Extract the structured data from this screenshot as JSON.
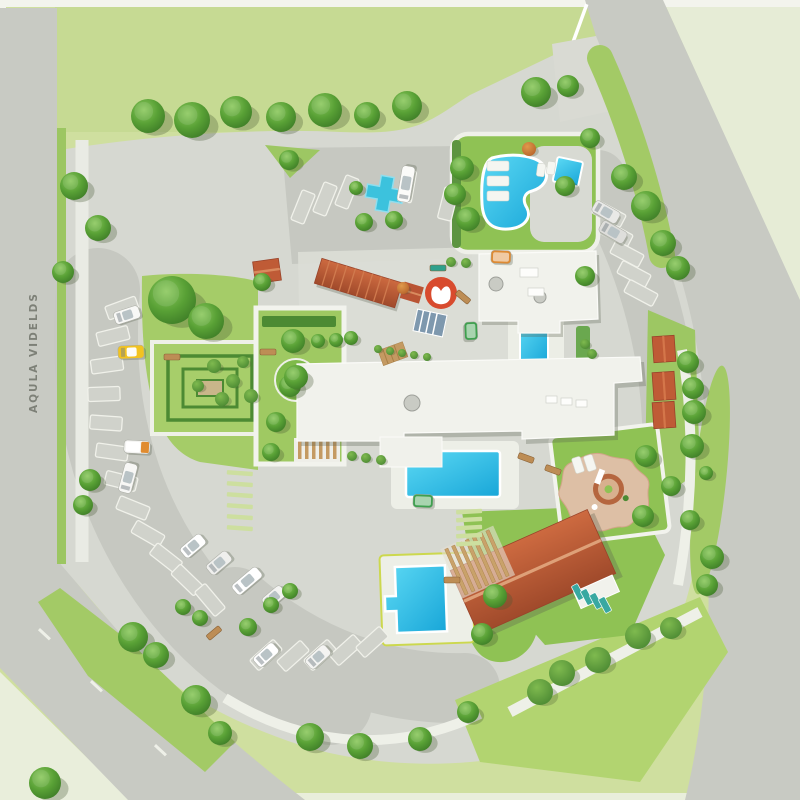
{
  "labels": {
    "road_label": "AQULA VIDELDS"
  },
  "palette": {
    "outer_lawn": "#cfdf9f",
    "top_lawn": "#c6da93",
    "pale_field": "#e6ecd6",
    "pale_corner": "#e9eedb",
    "road": "#c8cac3",
    "pavement": "#d6d8d1",
    "parking": "#c6c8c1",
    "plaza": "#dcded6",
    "path": "#f0f1ea",
    "white": "#f5f6f1",
    "stall": "#d0d2cb",
    "stripe": "#cddf9f",
    "lawn": "#8fc254",
    "lawn_mid": "#a5cc68",
    "lawn_bright": "#b2d470",
    "hedge": "#4c8a33",
    "water": "#2cc3e8",
    "water_deep": "#14a0d2",
    "roof_white": "#f1f2ec",
    "terracotta": "#bf5b36",
    "terracotta_dark": "#a04a2b",
    "logo_red": "#d84b2e",
    "taxi": "#f2c320",
    "teal": "#38a8a1",
    "wood": "#bd8d55",
    "sand": "#ddbfa5",
    "sand_ring": "#b5663f",
    "text": "#70746a"
  },
  "features_named": [
    "lagoon-pool",
    "spa-pool",
    "courtyard-pool",
    "main-pool",
    "family-pool",
    "splash-pad-cross",
    "hedge-maze-garden",
    "terrace-garden",
    "playground-star",
    "restaurant-red-roof",
    "entrance-canopy",
    "cabana-roofs",
    "resort-logo",
    "parking-left-arc",
    "parking-top",
    "parking-right-arc",
    "parking-bottom",
    "ring-road",
    "perimeter-roads",
    "taxi",
    "shuttle-buses",
    "gate-barrier"
  ],
  "features": {
    "trees": [
      [
        148,
        116,
        17
      ],
      [
        192,
        120,
        18
      ],
      [
        236,
        112,
        16
      ],
      [
        281,
        117,
        15
      ],
      [
        325,
        110,
        17
      ],
      [
        367,
        115,
        13
      ],
      [
        407,
        106,
        15
      ],
      [
        536,
        92,
        15
      ],
      [
        568,
        86,
        11
      ],
      [
        590,
        138,
        10
      ],
      [
        462,
        168,
        12
      ],
      [
        455,
        194,
        11
      ],
      [
        468,
        219,
        12
      ],
      [
        565,
        186,
        10
      ],
      [
        624,
        177,
        13
      ],
      [
        646,
        206,
        15
      ],
      [
        663,
        243,
        13
      ],
      [
        678,
        268,
        12
      ],
      [
        585,
        276,
        10
      ],
      [
        688,
        362,
        11
      ],
      [
        693,
        388,
        11
      ],
      [
        694,
        412,
        12
      ],
      [
        692,
        446,
        12
      ],
      [
        706,
        473,
        7
      ],
      [
        690,
        520,
        10
      ],
      [
        712,
        557,
        12
      ],
      [
        707,
        585,
        11
      ],
      [
        74,
        186,
        14
      ],
      [
        98,
        228,
        13
      ],
      [
        63,
        272,
        11
      ],
      [
        90,
        480,
        11
      ],
      [
        83,
        505,
        10
      ],
      [
        172,
        300,
        24
      ],
      [
        206,
        321,
        18
      ],
      [
        293,
        341,
        12
      ],
      [
        290,
        386,
        11
      ],
      [
        276,
        422,
        10
      ],
      [
        271,
        452,
        9
      ],
      [
        296,
        377,
        12
      ],
      [
        318,
        341,
        7
      ],
      [
        336,
        340,
        7
      ],
      [
        351,
        338,
        7
      ],
      [
        262,
        282,
        9
      ],
      [
        289,
        160,
        10
      ],
      [
        356,
        188,
        7
      ],
      [
        364,
        222,
        9
      ],
      [
        394,
        220,
        9
      ],
      [
        646,
        456,
        11
      ],
      [
        643,
        516,
        11
      ],
      [
        671,
        486,
        10
      ],
      [
        495,
        596,
        12
      ],
      [
        482,
        634,
        11
      ],
      [
        133,
        637,
        15
      ],
      [
        156,
        655,
        13
      ],
      [
        196,
        700,
        15
      ],
      [
        220,
        733,
        12
      ],
      [
        45,
        783,
        16
      ],
      [
        310,
        737,
        14
      ],
      [
        360,
        746,
        13
      ],
      [
        420,
        739,
        12
      ],
      [
        468,
        712,
        11
      ],
      [
        183,
        607,
        8
      ],
      [
        200,
        618,
        8
      ],
      [
        248,
        627,
        9
      ],
      [
        271,
        605,
        8
      ],
      [
        290,
        591,
        8
      ]
    ],
    "bushes": [
      [
        378,
        349,
        4
      ],
      [
        390,
        351,
        4
      ],
      [
        402,
        353,
        4
      ],
      [
        414,
        355,
        4
      ],
      [
        427,
        357,
        4
      ],
      [
        451,
        262,
        5
      ],
      [
        466,
        263,
        5
      ],
      [
        585,
        344,
        5
      ],
      [
        592,
        354,
        5
      ],
      [
        352,
        456,
        5
      ],
      [
        366,
        458,
        5
      ],
      [
        381,
        460,
        5
      ],
      [
        540,
        692,
        13
      ],
      [
        562,
        673,
        13
      ],
      [
        598,
        660,
        13
      ],
      [
        638,
        636,
        13
      ],
      [
        671,
        628,
        11
      ],
      [
        214,
        366,
        7
      ],
      [
        233,
        381,
        7
      ],
      [
        251,
        396,
        7
      ],
      [
        222,
        399,
        7
      ],
      [
        198,
        386,
        6
      ],
      [
        243,
        362,
        6
      ],
      [
        529,
        149,
        7,
        "orange"
      ],
      [
        403,
        288,
        6,
        "orange"
      ]
    ],
    "parking_stalls": [
      [
        122,
        308,
        -20
      ],
      [
        113,
        336,
        -14
      ],
      [
        107,
        365,
        -8
      ],
      [
        104,
        394,
        -2
      ],
      [
        106,
        423,
        4
      ],
      [
        112,
        452,
        8
      ],
      [
        121,
        481,
        14
      ],
      [
        133,
        508,
        22
      ],
      [
        148,
        534,
        30
      ],
      [
        166,
        558,
        38
      ],
      [
        187,
        580,
        44
      ],
      [
        210,
        600,
        50
      ],
      [
        266,
        655,
        -42
      ],
      [
        293,
        656,
        -42
      ],
      [
        320,
        655,
        -42
      ],
      [
        346,
        650,
        -42
      ],
      [
        372,
        642,
        -42
      ],
      [
        303,
        207,
        -68
      ],
      [
        325,
        199,
        -68
      ],
      [
        347,
        192,
        -68
      ],
      [
        407,
        186,
        -80
      ],
      [
        448,
        204,
        -76
      ],
      [
        609,
        214,
        28
      ],
      [
        616,
        234,
        28
      ],
      [
        627,
        254,
        28
      ],
      [
        634,
        274,
        28
      ],
      [
        641,
        293,
        28
      ]
    ],
    "vehicles": [
      [
        127,
        315,
        -18,
        "#f8f8f6",
        26
      ],
      [
        131,
        352,
        -2,
        "#f2c320",
        26,
        "taxi"
      ],
      [
        137,
        447,
        3,
        "#f4f4f2",
        26,
        "truck"
      ],
      [
        128,
        478,
        -75,
        "#f7f7f5",
        30
      ],
      [
        193,
        546,
        -40,
        "#ffffff",
        26
      ],
      [
        219,
        563,
        -40,
        "#efefed",
        26
      ],
      [
        247,
        581,
        -40,
        "#ffffff",
        32
      ],
      [
        274,
        597,
        -40,
        "#f3f3f1",
        24
      ],
      [
        266,
        655,
        -42,
        "#ffffff",
        26
      ],
      [
        318,
        657,
        -42,
        "#f4f4f2",
        26
      ],
      [
        406,
        184,
        -80,
        "#fbfbf9",
        36,
        "van"
      ],
      [
        606,
        212,
        30,
        "#e9e9e7",
        28
      ],
      [
        613,
        232,
        30,
        "#dededb",
        28
      ],
      [
        501,
        257,
        2,
        "#dd8a33",
        20,
        "bus"
      ],
      [
        471,
        331,
        88,
        "#3fa04f",
        18,
        "bus"
      ],
      [
        423,
        501,
        2,
        "#3fa04f",
        20,
        "bus"
      ]
    ],
    "teal_loungers": [
      [
        578,
        592,
        -28
      ],
      [
        587,
        597,
        -28
      ],
      [
        596,
        601,
        -28
      ],
      [
        605,
        605,
        -28
      ]
    ],
    "white_loungers": [
      [
        498,
        166,
        0,
        22,
        10
      ],
      [
        498,
        181,
        0,
        22,
        10
      ],
      [
        498,
        196,
        0,
        22,
        10
      ],
      [
        541,
        170,
        8,
        8,
        13
      ],
      [
        551,
        168,
        8,
        8,
        13
      ],
      [
        578,
        465,
        -18,
        9,
        16
      ],
      [
        590,
        463,
        -18,
        9,
        16
      ]
    ],
    "benches": [
      [
        463,
        297,
        40
      ],
      [
        172,
        357,
        0
      ],
      [
        214,
        633,
        -40
      ],
      [
        452,
        580,
        0
      ],
      [
        526,
        458,
        20
      ],
      [
        553,
        470,
        20
      ],
      [
        268,
        352,
        0
      ],
      [
        438,
        268,
        0,
        "#2fa08c"
      ]
    ],
    "crosswalk_stripes": [
      [
        456,
        510,
        -3
      ],
      [
        456,
        518,
        -3
      ],
      [
        456,
        526,
        -3
      ],
      [
        456,
        534,
        -3
      ],
      [
        456,
        542,
        -3
      ],
      [
        227,
        470,
        4
      ],
      [
        227,
        481,
        4
      ],
      [
        227,
        492,
        4
      ],
      [
        227,
        503,
        4
      ],
      [
        227,
        514,
        4
      ],
      [
        227,
        525,
        4
      ]
    ],
    "road_dashes": [
      [
        92,
        680,
        43
      ],
      [
        156,
        744,
        43
      ],
      [
        40,
        628,
        43
      ]
    ]
  }
}
